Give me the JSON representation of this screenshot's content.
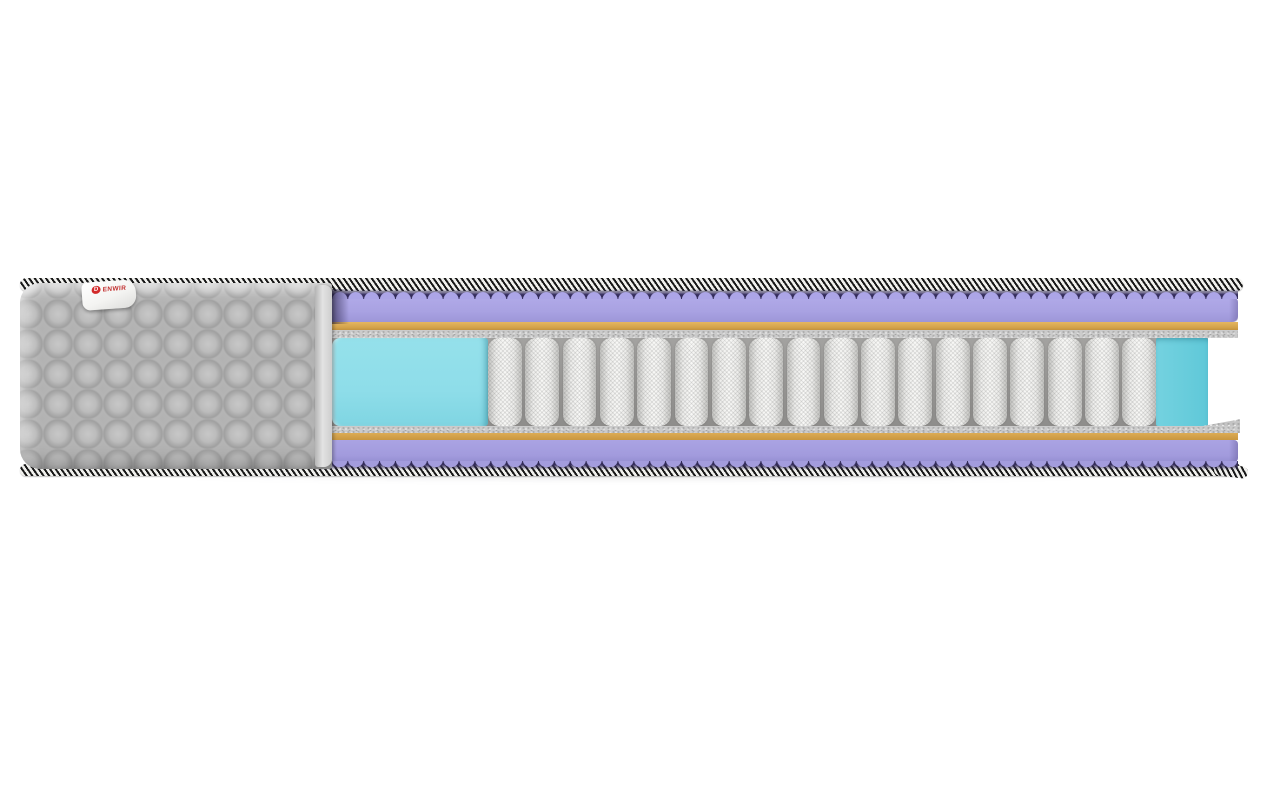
{
  "scene": {
    "type": "product-render",
    "subject": "mattress-cross-section-cutaway",
    "background_color": "#ffffff"
  },
  "brand": {
    "label_text": "ENWIR",
    "logo_letter": "D",
    "label_color": "#c23030",
    "tab_color": "#ffffff"
  },
  "construction": {
    "spring_count": 18,
    "layers_top_to_bottom": [
      {
        "name": "edge-tape-top",
        "pattern": "black-white-diagonal-stripes",
        "colors": [
          "#181818",
          "#f1f1ee"
        ]
      },
      {
        "name": "quilted-cover",
        "color": "#b2b2b2"
      },
      {
        "name": "wave-foam-top",
        "color": "#a9a2e2",
        "trough_color": "#372f61"
      },
      {
        "name": "firm-layer-top",
        "color": "#d3a24a"
      },
      {
        "name": "felt-pad-top",
        "color": "#cbcbcb"
      },
      {
        "name": "edge-support-foam-left",
        "color": "#8edde9"
      },
      {
        "name": "pocket-spring-core",
        "color": "#f2f2f0"
      },
      {
        "name": "edge-support-foam-right",
        "color": "#5fc8d8"
      },
      {
        "name": "felt-pad-bottom",
        "color": "#cbcbcb"
      },
      {
        "name": "firm-layer-bottom",
        "color": "#c9973f"
      },
      {
        "name": "wave-foam-bottom",
        "color": "#a29bdd",
        "trough_color": "#352d5c"
      },
      {
        "name": "edge-tape-bottom",
        "pattern": "black-white-diagonal-stripes",
        "colors": [
          "#181818",
          "#f1f1ee"
        ]
      }
    ]
  }
}
